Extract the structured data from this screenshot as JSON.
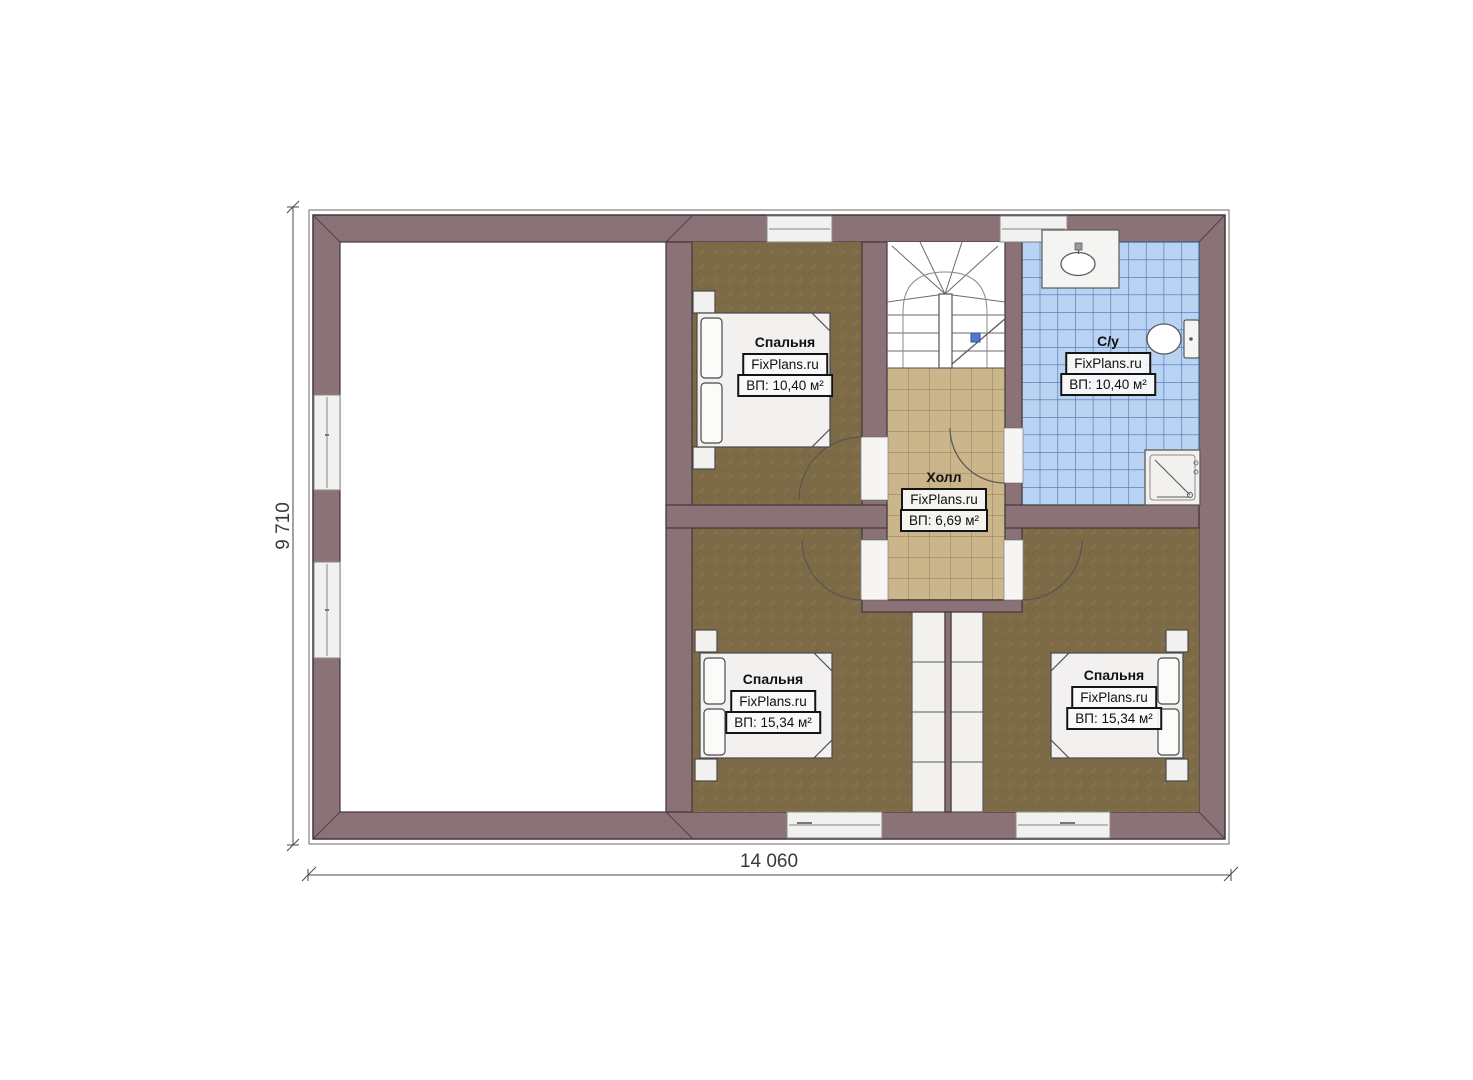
{
  "plan": {
    "watermark": "FixPlans.ru",
    "rooms": [
      {
        "id": "bedroom-top",
        "name": "Спальня",
        "area": "ВП: 10,40 м²"
      },
      {
        "id": "bathroom",
        "name": "С/у",
        "area": "ВП: 10,40 м²"
      },
      {
        "id": "hall",
        "name": "Холл",
        "area": "ВП: 6,69 м²"
      },
      {
        "id": "bedroom-bottom-left",
        "name": "Спальня",
        "area": "ВП: 15,34 м²"
      },
      {
        "id": "bedroom-bottom-right",
        "name": "Спальня",
        "area": "ВП: 15,34 м²"
      }
    ],
    "dimensions": {
      "width": "14 060",
      "height": "9 710"
    },
    "fixtures": [
      "staircase-icon",
      "bed-icon",
      "sink-icon",
      "toilet-icon",
      "shower-icon",
      "window-icon",
      "door-swing-icon",
      "wardrobe-icon"
    ],
    "colors": {
      "wall": "#8b7277",
      "wall_outline": "#42363b",
      "bedroom_floor": "#7d6b48",
      "hall_tile": "#cbb68b",
      "bath_tile": "#b9d3f3",
      "bath_grid": "#4a70b2",
      "stair_marker_blue": "#5577cf"
    }
  }
}
